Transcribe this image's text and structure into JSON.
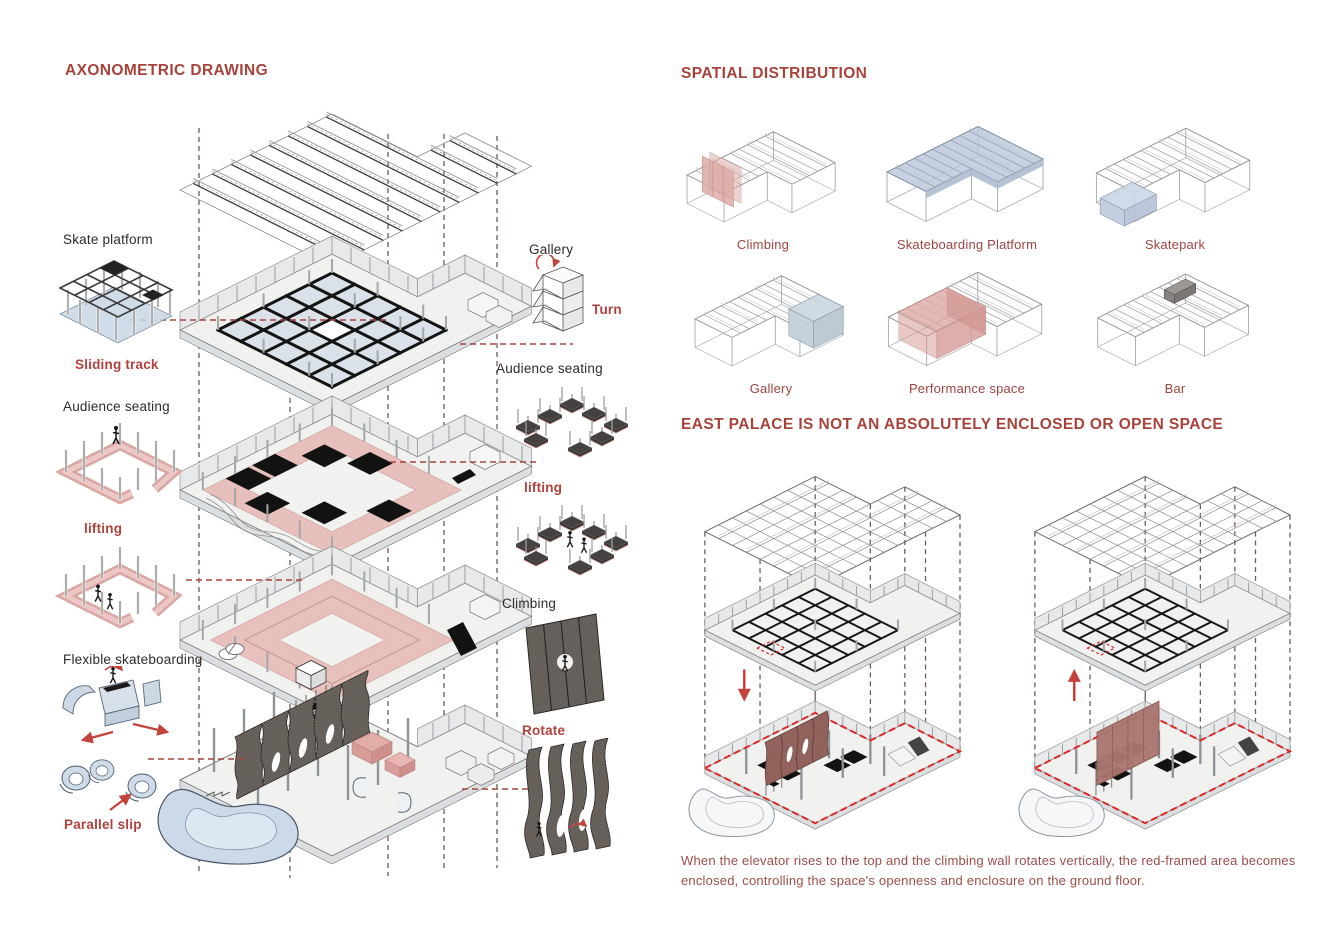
{
  "colors": {
    "accent_red": "#a8433c",
    "label_red": "#b0413c",
    "pink_fill": "#e6bab6",
    "blue_fill": "#c9d6e6",
    "wall_dark": "#5d5753",
    "red_frame": "#e02521"
  },
  "axonometric": {
    "title": "AXONOMETRIC DRAWING",
    "left_labels": {
      "skate_platform": "Skate platform",
      "sliding_track": "Sliding track",
      "audience_seating": "Audience seating",
      "lifting": "lifting",
      "flexible_skateboarding": "Flexible skateboarding",
      "parallel_slip": "Parallel slip"
    },
    "right_labels": {
      "gallery": "Gallery",
      "turn": "Turn",
      "audience_seating": "Audience seating",
      "lifting": "lifting",
      "climbing": "Climbing",
      "rotate": "Rotate"
    }
  },
  "spatial": {
    "title": "SPATIAL DISTRIBUTION",
    "items": [
      {
        "label": "Climbing",
        "highlight": "#dfaca7"
      },
      {
        "label": "Skateboarding Platform",
        "highlight": "#b9c6d9"
      },
      {
        "label": "Skatepark",
        "highlight": "#ccd7e6"
      },
      {
        "label": "Gallery",
        "highlight": "#c2cfda"
      },
      {
        "label": "Performance space",
        "highlight": "#dfa8a3"
      },
      {
        "label": "Bar",
        "highlight": "#9b9794"
      }
    ]
  },
  "east_palace": {
    "title": "EAST PALACE IS NOT AN ABSOLUTELY ENCLOSED OR OPEN SPACE",
    "caption": "When the elevator rises to the top and the climbing wall rotates vertically, the red-framed area becomes enclosed, controlling the space's openness and enclosure on the ground floor."
  }
}
